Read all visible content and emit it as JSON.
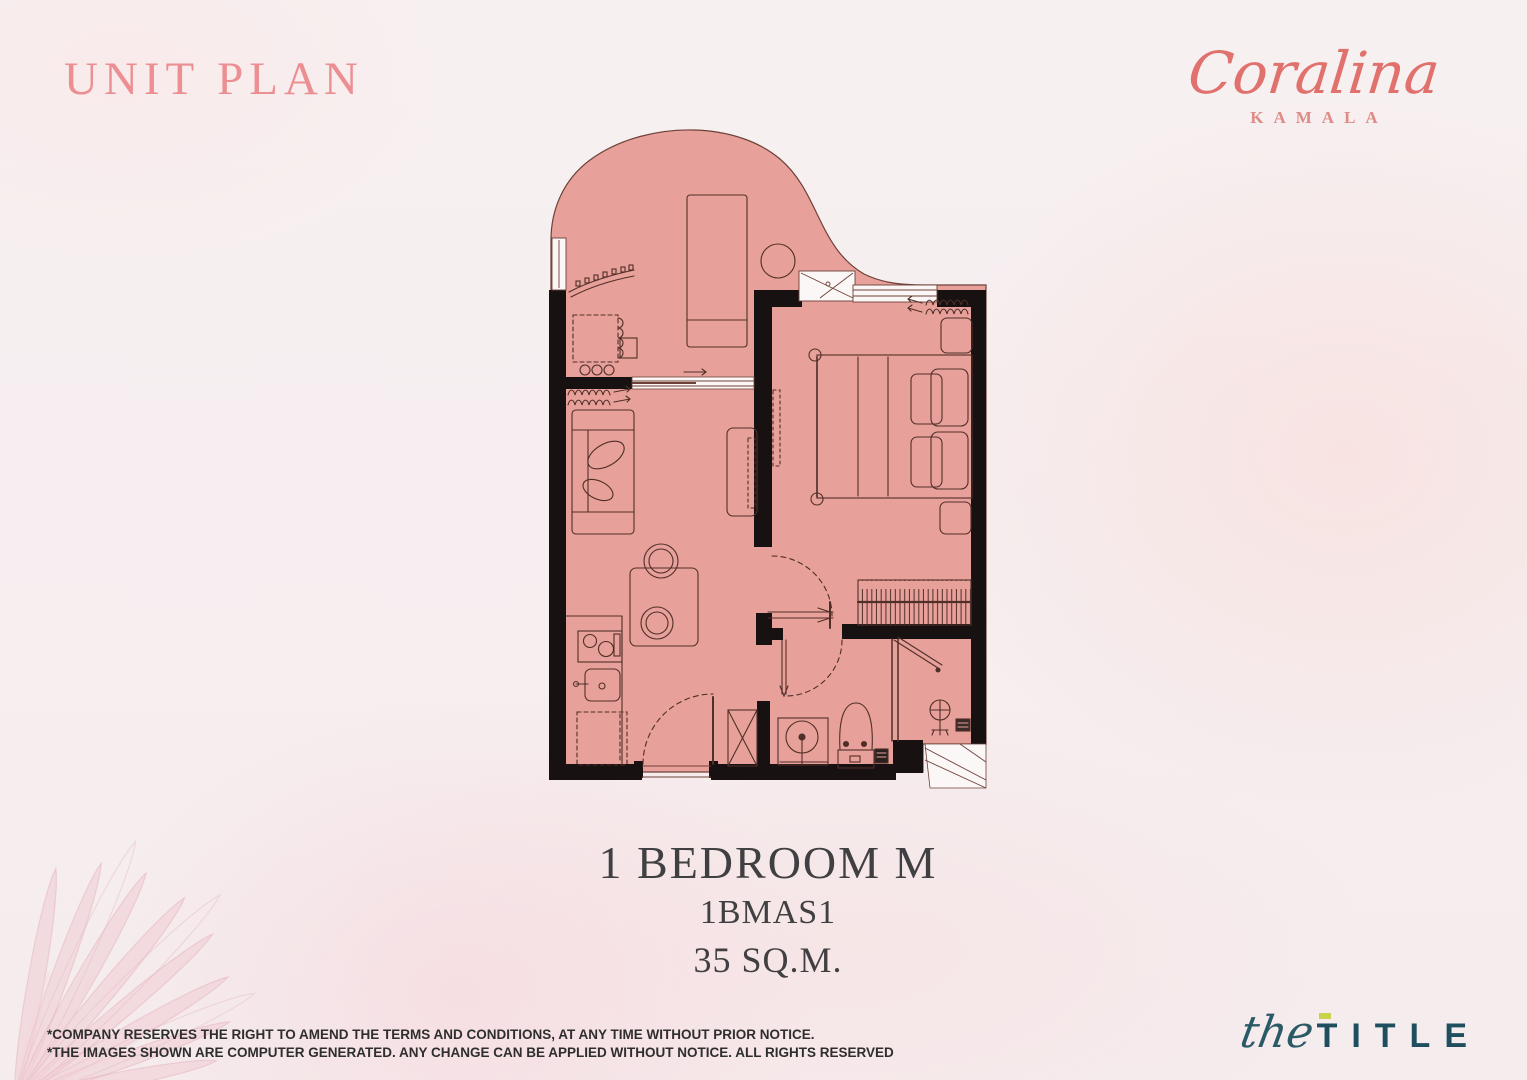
{
  "header": {
    "title": "UNIT PLAN",
    "color": "#ec8f92"
  },
  "brand": {
    "name": "Coralina",
    "location": "KAMALA",
    "color": "#e0716d"
  },
  "unit": {
    "type": "1 BEDROOM M",
    "code": "1BMAS1",
    "area": "35 SQ.M."
  },
  "plan": {
    "fill_color": "#e8a09a",
    "wall_color": "#171112",
    "furniture_line_color": "#4f2f28"
  },
  "footer": {
    "disclaimer_line1": "*COMPANY RESERVES THE RIGHT TO AMEND THE TERMS AND CONDITIONS, AT ANY TIME WITHOUT PRIOR NOTICE.",
    "disclaimer_line2": "*THE IMAGES SHOWN ARE COMPUTER GENERATED. ANY CHANGE CAN BE APPLIED WITHOUT NOTICE. ALL RIGHTS RESERVED",
    "logo_script": "the",
    "logo_caps": "TITLE",
    "logo_color": "#1f4f5f",
    "logo_accent_color": "#c9d24b"
  }
}
